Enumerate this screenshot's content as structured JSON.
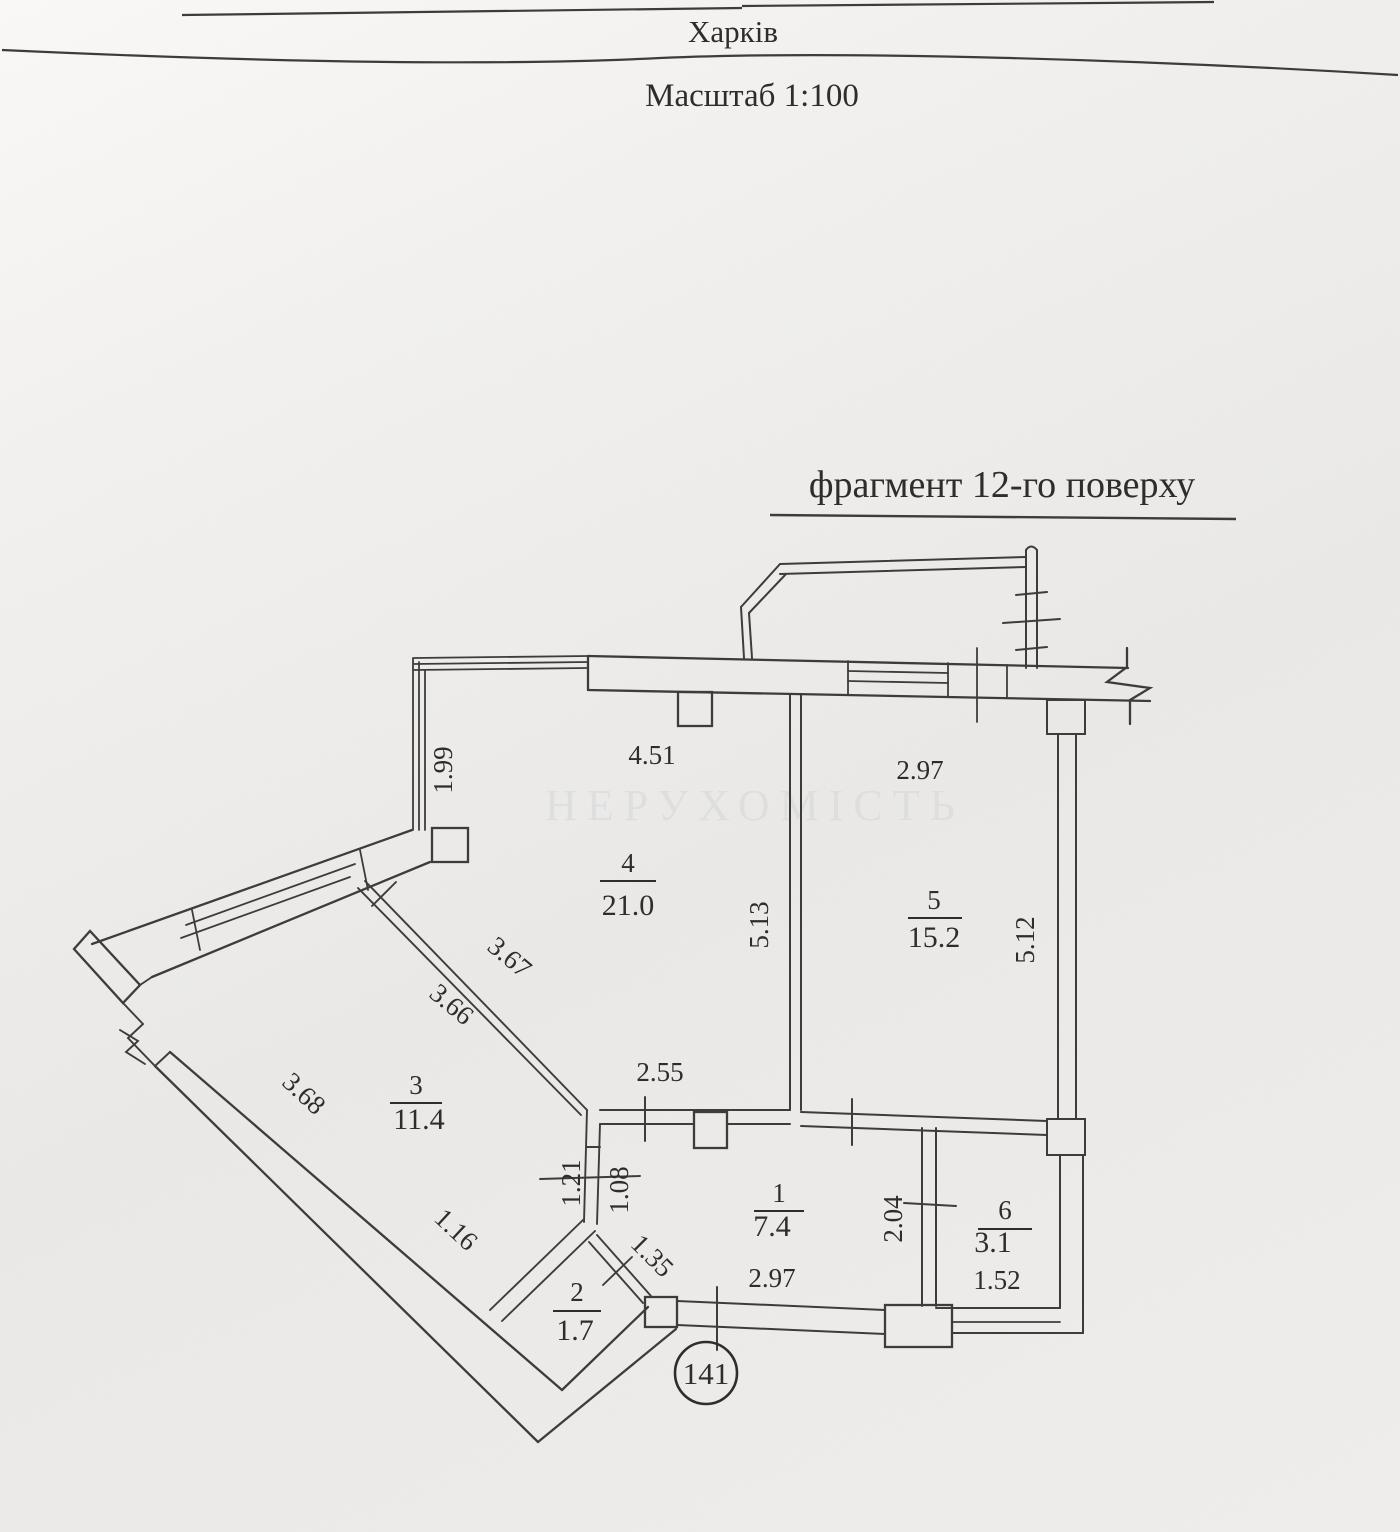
{
  "header": {
    "city": "Харків",
    "scale": "Масштаб 1:100"
  },
  "title": "фрагмент 12-го поверху",
  "watermark": "НЕРУХОМІСТЬ",
  "apartment": {
    "number": "141"
  },
  "rooms": {
    "r1": {
      "number": "1",
      "area": "7.4"
    },
    "r2": {
      "number": "2",
      "area": "1.7"
    },
    "r3": {
      "number": "3",
      "area": "11.4"
    },
    "r4": {
      "number": "4",
      "area": "21.0"
    },
    "r5": {
      "number": "5",
      "area": "15.2"
    },
    "r6": {
      "number": "6",
      "area": "3.1"
    }
  },
  "dims": {
    "d199": "1.99",
    "d451": "4.51",
    "d297top": "2.97",
    "d513": "5.13",
    "d512": "5.12",
    "d367": "3.67",
    "d366": "3.66",
    "d368": "3.68",
    "d255": "2.55",
    "d121": "1.21",
    "d108": "1.08",
    "d116": "1.16",
    "d135": "1.35",
    "d297bottom": "2.97",
    "d204": "2.04",
    "d152": "1.52"
  }
}
